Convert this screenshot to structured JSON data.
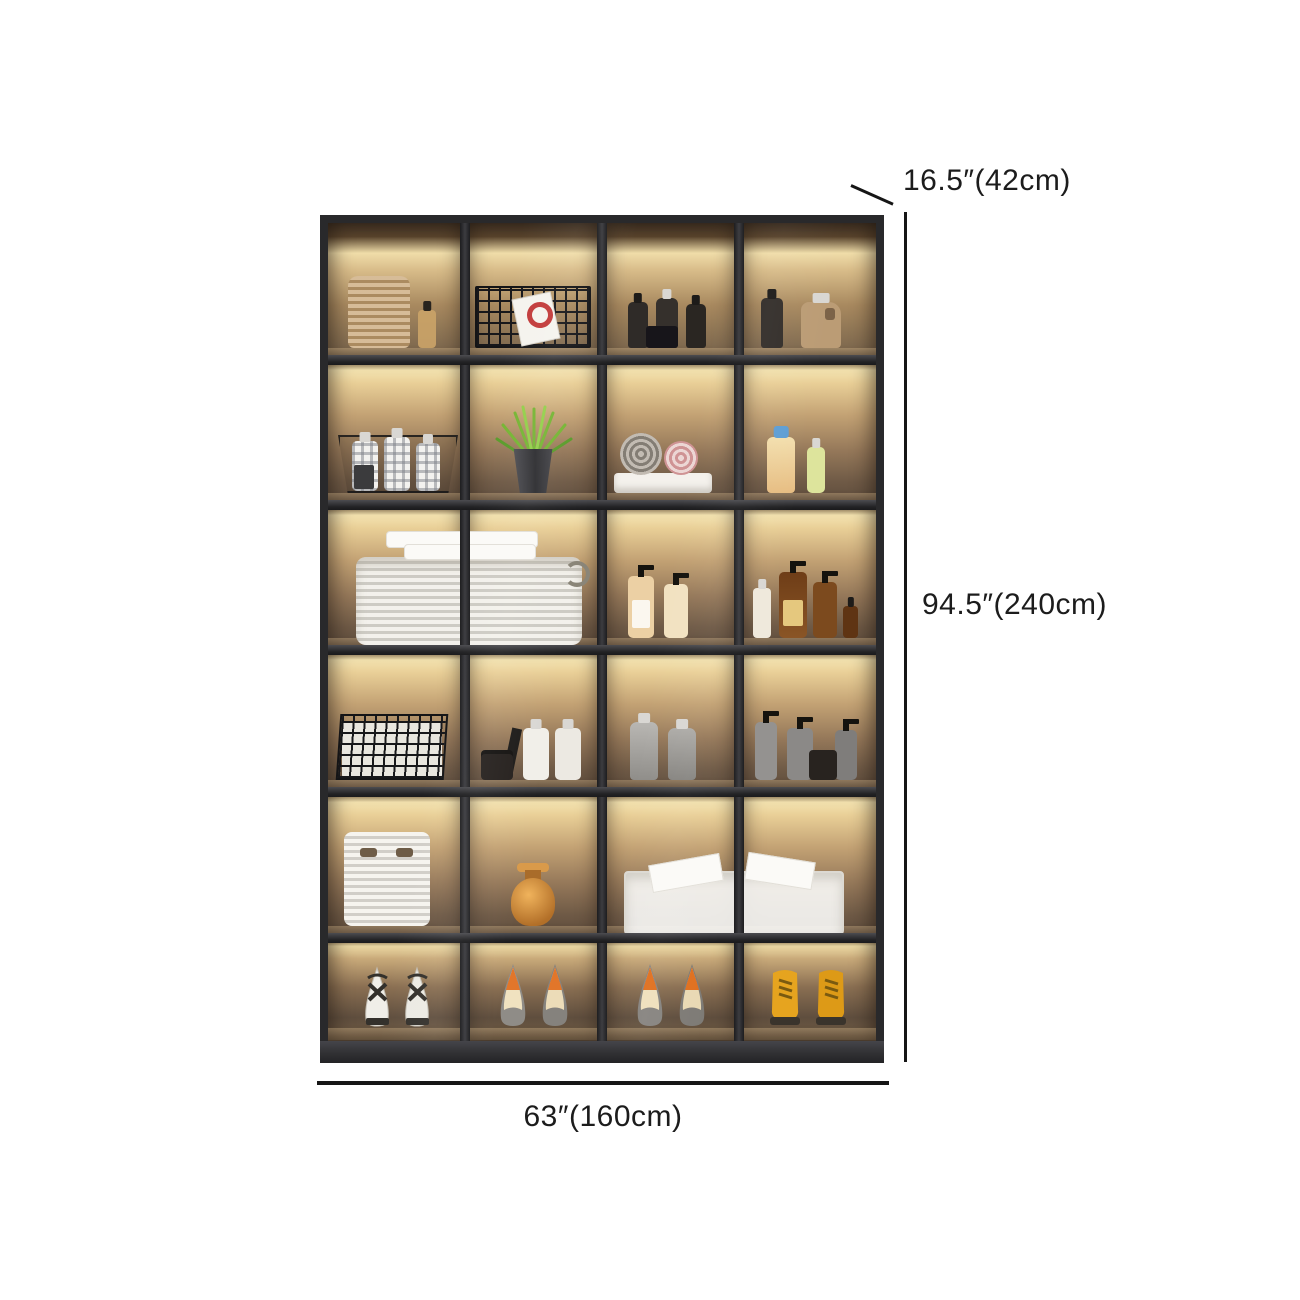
{
  "annotations": {
    "depth_label": "16.5″(42cm)",
    "height_label": "94.5″(240cm)",
    "width_label": "63″(160cm)"
  },
  "cabinet": {
    "description": "black-framed glass-door display cabinet with warm LED-lit compartments",
    "rows": 6,
    "columns": 4,
    "colors": {
      "frame": "#29292b",
      "interior_glow": "#f4e3b0",
      "interior_wall": "#96795a",
      "base": "#3f3f43",
      "dimension_line": "#161616"
    },
    "inventory": [
      {
        "row": 1,
        "cells": [
          "woven basket stack and glass bottle",
          "black wire basket with magazine",
          "dark toiletry bottles and jar",
          "dark bottle and tan jug"
        ]
      },
      {
        "row": 2,
        "cells": [
          "wire basket with plaid-pattern bottles",
          "green grass plant in metal pot",
          "rolled towels on folded white towel",
          "cream bottle with blue cap and green bottle"
        ]
      },
      {
        "row": 3,
        "cells": [
          "large white laundry basket with towels (spans columns 1-2)",
          "",
          "beige pump bottles",
          "amber shampoo pump bottles"
        ]
      },
      {
        "row": 4,
        "cells": [
          "black wire basket with white linens",
          "dark jar and white canisters",
          "gray detergent bottles",
          "gray pump bottles and dark jar"
        ]
      },
      {
        "row": 5,
        "cells": [
          "white storage bag with handle slots",
          "terracotta vase",
          "clear plastic storage bin with tissue (spans columns 3-4)",
          ""
        ]
      },
      {
        "row": 6,
        "cells": [
          "white heeled sandals",
          "gray pumps with orange lining",
          "gray pumps with orange lining",
          "yellow lace-up ankle boots"
        ]
      }
    ]
  }
}
